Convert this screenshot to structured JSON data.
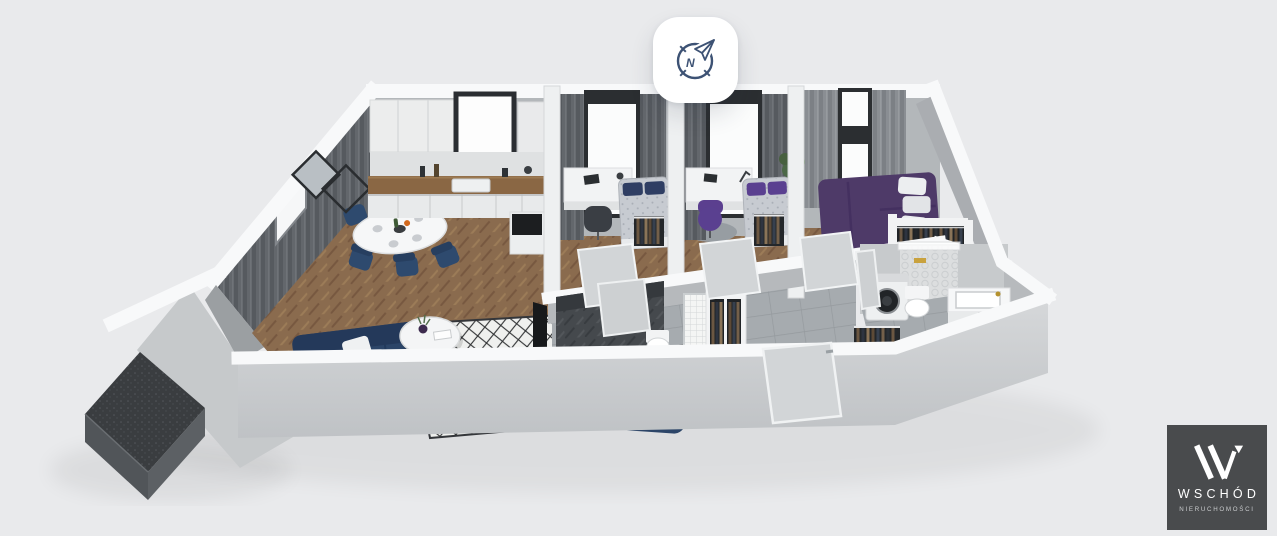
{
  "viewer": {
    "background_color": "#e9eaec",
    "compass_button": {
      "icon": "compass-north",
      "cardinal_label": "N"
    },
    "watermark": {
      "monogram_icon": "w-monogram",
      "brand": "WSCHÓD",
      "tagline": "NIERUCHOMOŚCI"
    },
    "scene": {
      "kind": "3d-floorplan-render",
      "view": "isometric cutaway from above",
      "rooms": [
        "balcony",
        "living-room",
        "kitchenette",
        "dining-area",
        "bedroom-1",
        "bedroom-2",
        "master-bedroom",
        "hallway",
        "shower-wc",
        "entry-wardrobe",
        "bathroom"
      ]
    }
  },
  "colors": {
    "background": "#e9eaec",
    "white": "#ffffff",
    "wallTop": "#f8f9fa",
    "wallFace": "#c7cacc",
    "wallFaceLight": "#d7d9db",
    "wallFaceDark": "#b6b9bc",
    "backWall": "#b3b7ba",
    "floorWood": "#8a6b4e",
    "floorTile": "#a6abaf",
    "floorTileDark": "#45494d",
    "balconyDeck": "#3a3d40",
    "balconySide": "#54585c",
    "curtainDark": "#5f6368",
    "curtainLight": "#84888d",
    "sofaNavy": "#2c4568",
    "chairNavy": "#2e4a6e",
    "bedPurple": "#4e3a68",
    "pillowPurple": "#5a4090",
    "pillowNavy": "#2f3e63",
    "counterWood": "#8a6744",
    "rugBase": "#eff0ee",
    "rugInk": "#2c2e30",
    "doorPanel": "#d2d5d7",
    "applianceDark": "#212427",
    "compassInk": "#3d5274",
    "logoBg": "#494b4d",
    "logoFg": "#ffffff",
    "logoMuted": "#c9cbcd"
  }
}
